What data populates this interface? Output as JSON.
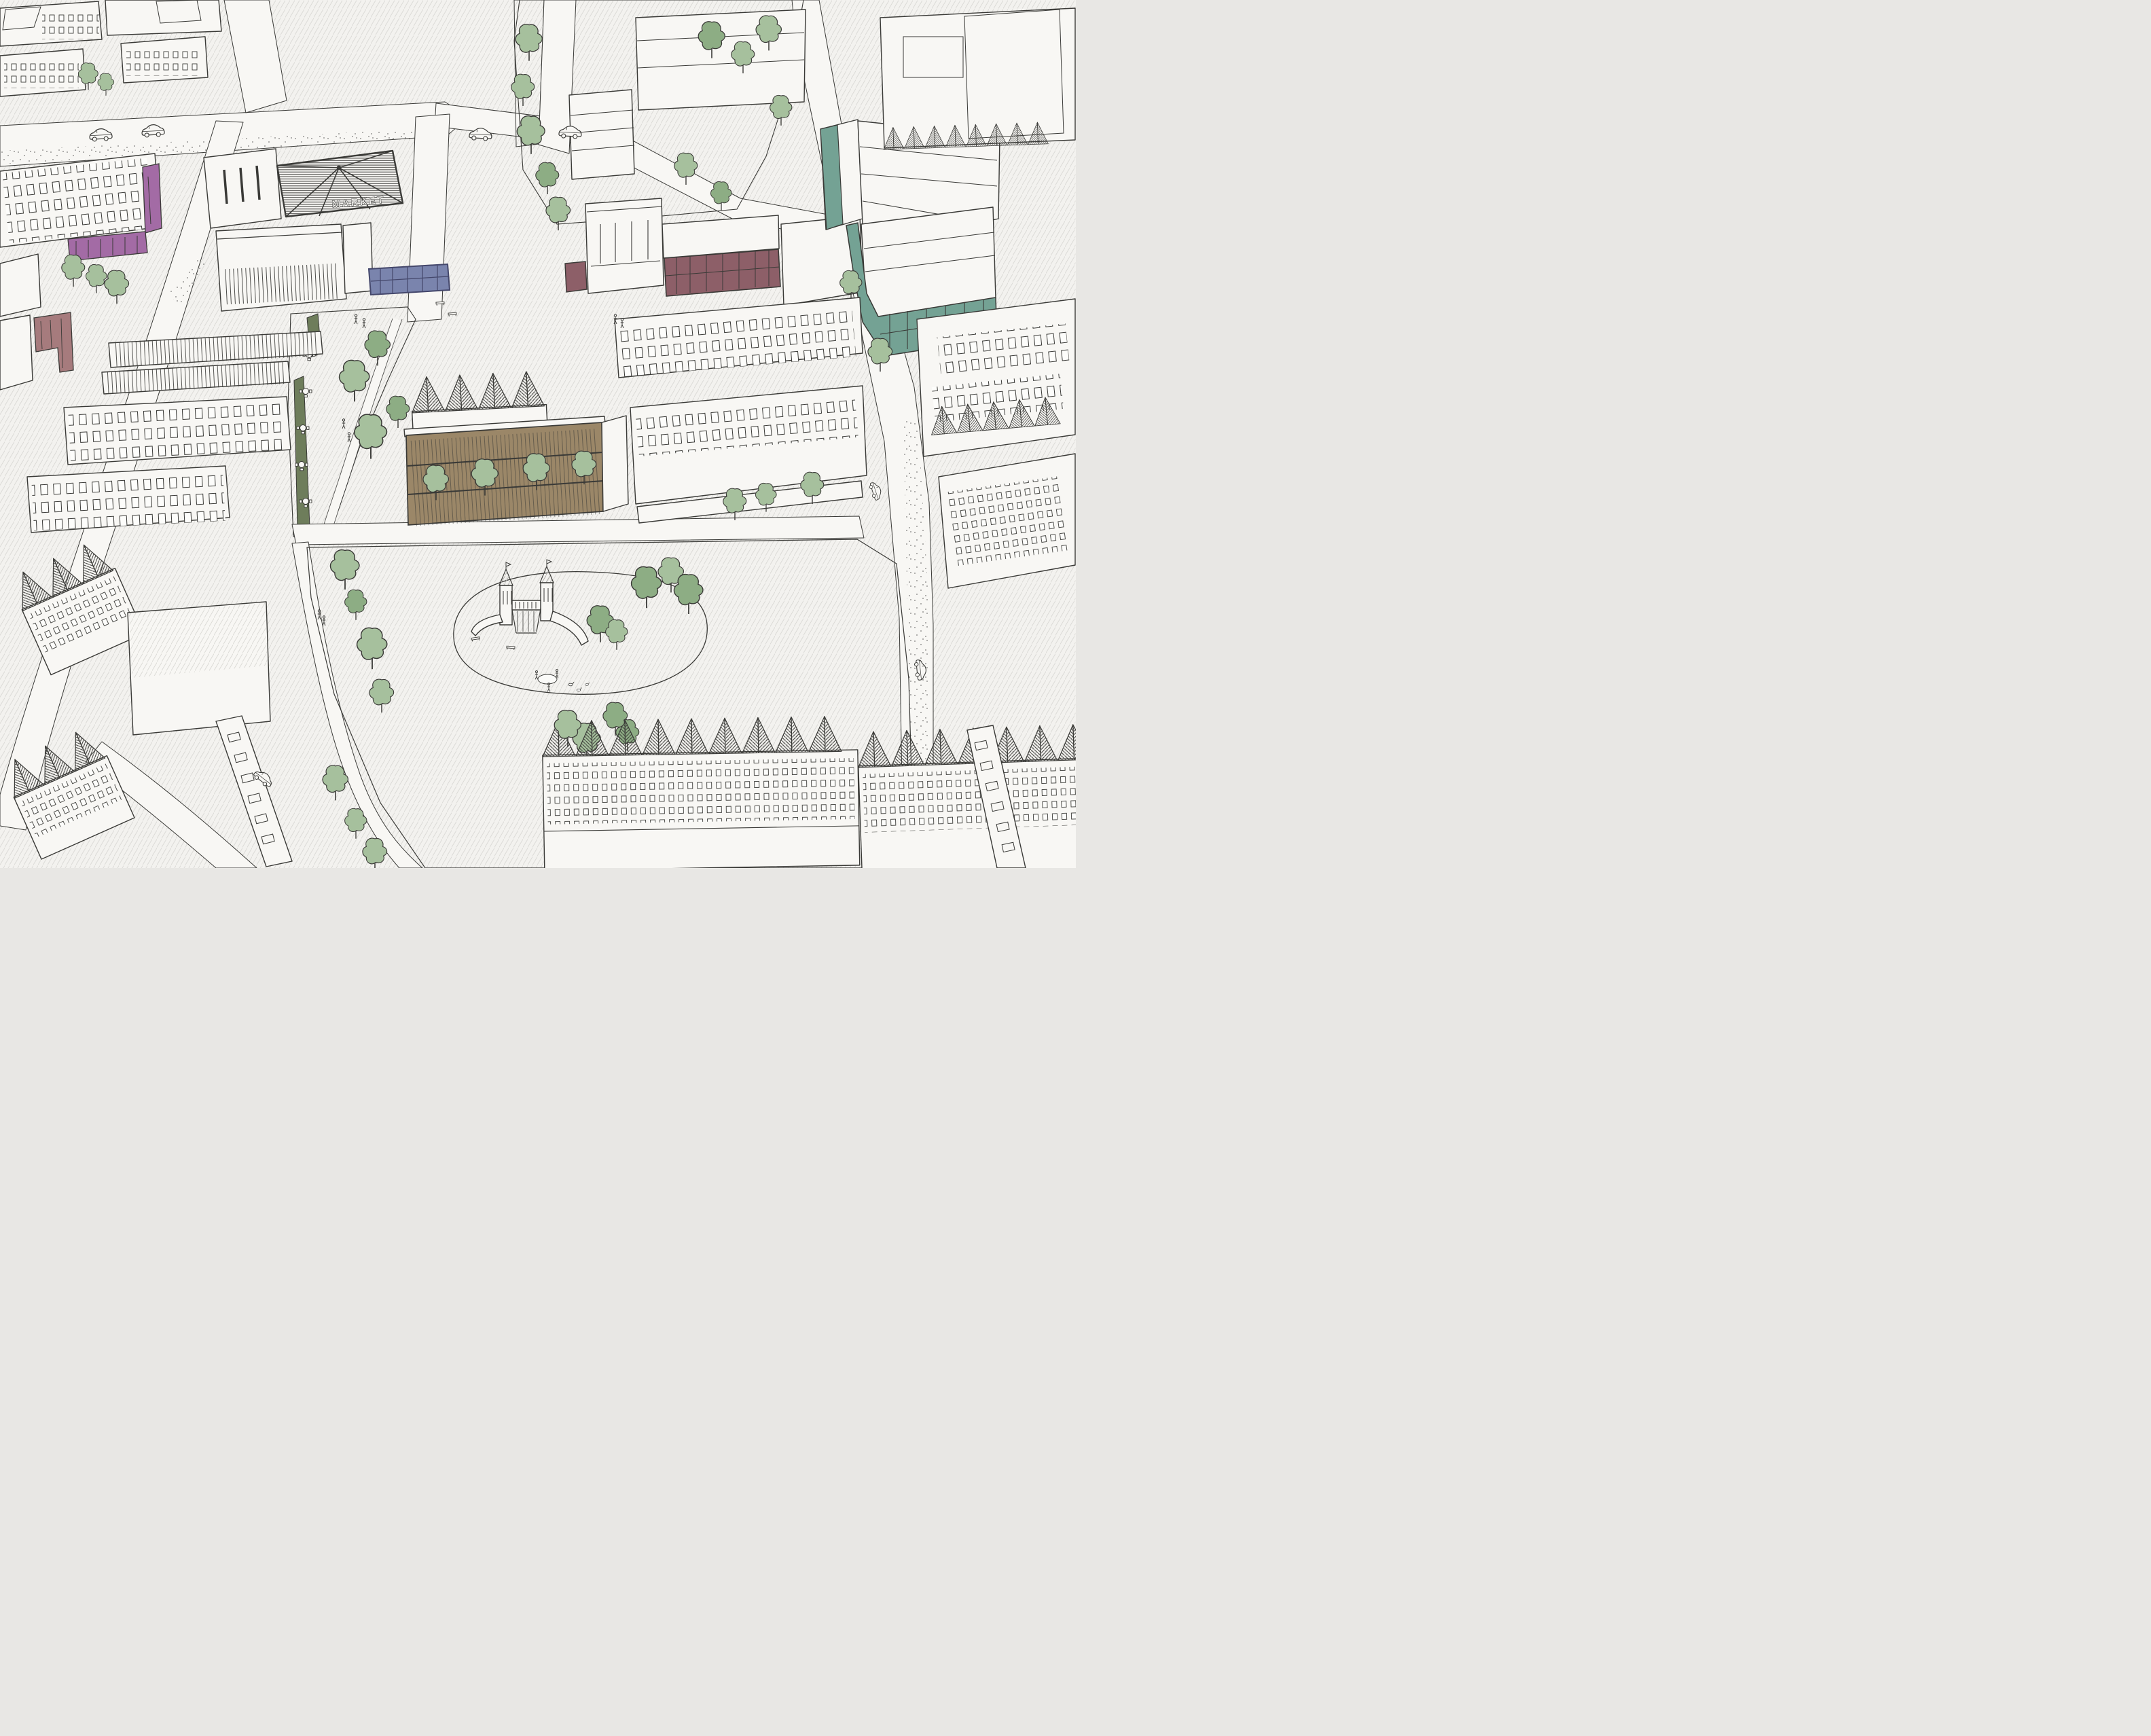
{
  "scene": {
    "type": "hand-drawn aerial axonometric masterplan sketch of a neighbourhood",
    "market_label": "MARKET"
  },
  "palette": {
    "paper": "#f3f2ef",
    "bldg": "#f8f7f4",
    "ink": "#3a3a37",
    "hatch": "#dcdbd7",
    "hatchdark": "#b2b1ad",
    "shadow": "#c7c6c2",
    "grass": "#ccd8c6",
    "grassdash": "#a0b59c",
    "grasslight": "#dfe9db",
    "grasslightdash": "#c2d3be",
    "tree": "#a6c09d",
    "treedark": "#8dad84",
    "purple": "#a36ba5",
    "redleft": "#a67b7d",
    "maroon": "#8d5f68",
    "blue": "#7a84ad",
    "bluedark": "#44476b",
    "teal": "#74a294",
    "olive": "#6e7d5b",
    "brown": "#9b8768"
  },
  "features": [
    {
      "id": "market-hall",
      "label": "MARKET",
      "highlight": "ink"
    },
    {
      "id": "purple-ground-floor-building",
      "highlight": "purple"
    },
    {
      "id": "red-corner-building-west",
      "highlight": "redleft"
    },
    {
      "id": "maroon-ground-floor-row",
      "highlight": "maroon"
    },
    {
      "id": "blue-ground-floor-pavilion",
      "highlight": "blue"
    },
    {
      "id": "teal-ground-floor-complex",
      "highlight": "teal"
    },
    {
      "id": "timber-faced-building",
      "highlight": "brown"
    },
    {
      "id": "olive-kiosk-strip",
      "highlight": "olive"
    },
    {
      "id": "central-park",
      "highlight": "grass"
    },
    {
      "id": "playground-castle",
      "highlight": "grasslight"
    },
    {
      "id": "cafe-lane",
      "highlight": "grass"
    },
    {
      "id": "north-lawn",
      "highlight": "grass"
    },
    {
      "id": "townhouse-rows",
      "highlight": "bldg"
    }
  ]
}
